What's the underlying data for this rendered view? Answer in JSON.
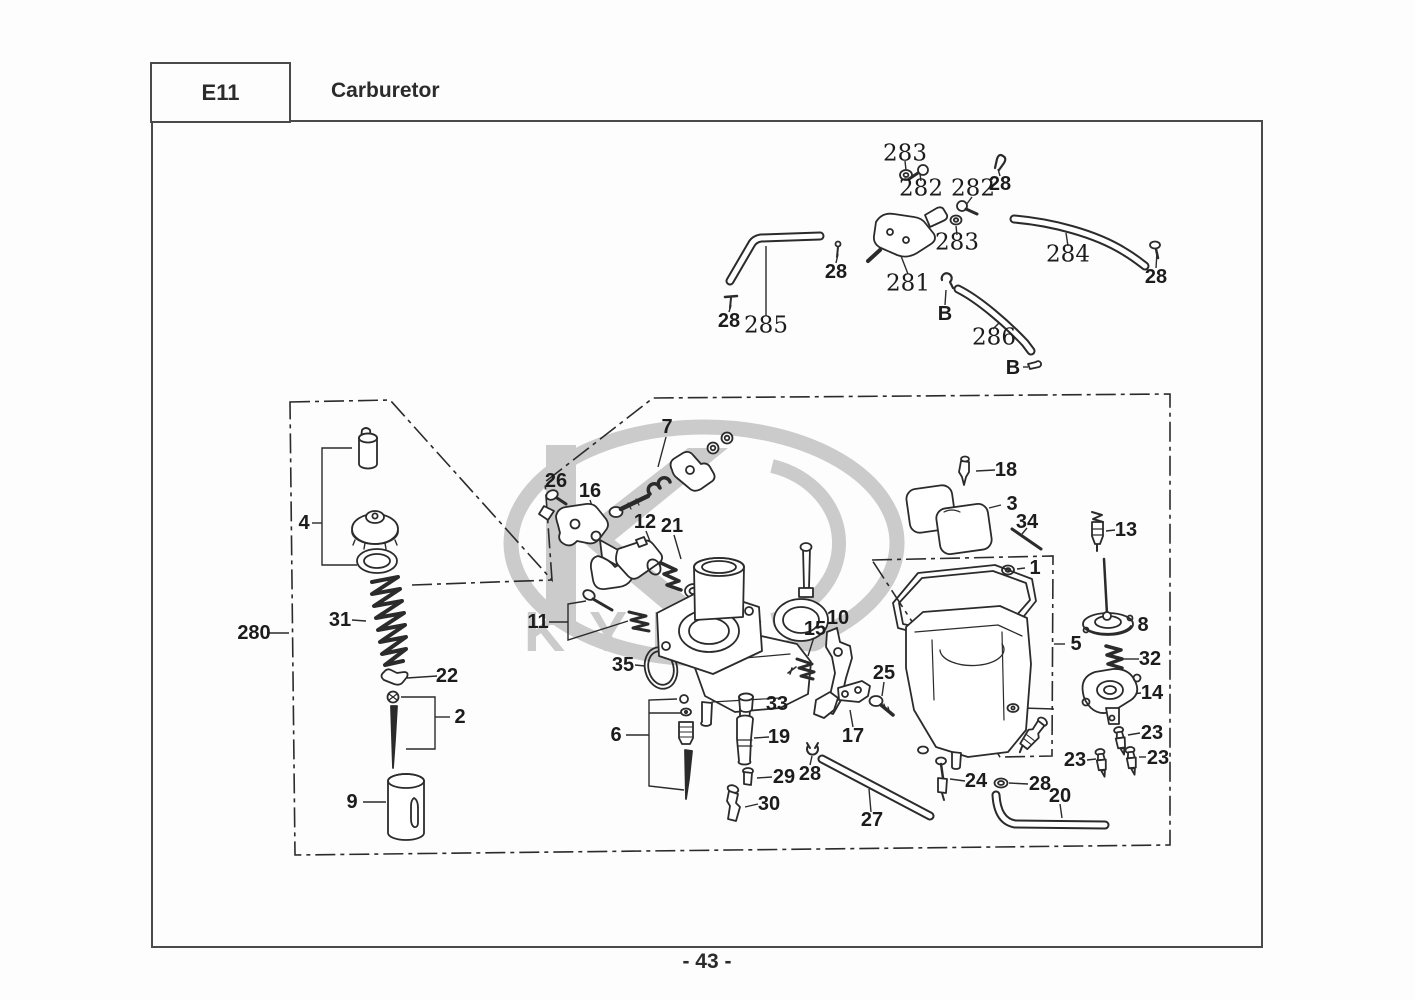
{
  "header": {
    "code": "E11",
    "title": "Carburetor"
  },
  "footer": {
    "page_number": "- 43 -"
  },
  "watermark": {
    "brand": "KYMCO",
    "color": "#cbcbcb"
  },
  "colors": {
    "line": "#2b2b2b",
    "frame": "#4a4a4a",
    "watermark": "#cbcbcb"
  },
  "callouts": [
    {
      "text": "283",
      "x": 905,
      "y": 154,
      "style": "serif"
    },
    {
      "text": "282",
      "x": 921,
      "y": 189,
      "style": "serif"
    },
    {
      "text": "282",
      "x": 973,
      "y": 189,
      "style": "serif"
    },
    {
      "text": "283",
      "x": 957,
      "y": 243,
      "style": "serif"
    },
    {
      "text": "28",
      "x": 1000,
      "y": 184,
      "style": "sans"
    },
    {
      "text": "281",
      "x": 908,
      "y": 284,
      "style": "serif"
    },
    {
      "text": "284",
      "x": 1068,
      "y": 255,
      "style": "serif"
    },
    {
      "text": "28",
      "x": 1156,
      "y": 277,
      "style": "sans"
    },
    {
      "text": "28",
      "x": 836,
      "y": 272,
      "style": "sans"
    },
    {
      "text": "285",
      "x": 766,
      "y": 326,
      "style": "serif"
    },
    {
      "text": "28",
      "x": 729,
      "y": 321,
      "style": "sans"
    },
    {
      "text": "B",
      "x": 945,
      "y": 314,
      "style": "sans"
    },
    {
      "text": "286",
      "x": 994,
      "y": 338,
      "style": "serif"
    },
    {
      "text": "B",
      "x": 1013,
      "y": 368,
      "style": "sans"
    },
    {
      "text": "280",
      "x": 254,
      "y": 633,
      "style": "sans"
    },
    {
      "text": "4",
      "x": 304,
      "y": 523,
      "style": "sans"
    },
    {
      "text": "31",
      "x": 340,
      "y": 620,
      "style": "sans"
    },
    {
      "text": "22",
      "x": 447,
      "y": 676,
      "style": "sans"
    },
    {
      "text": "2",
      "x": 460,
      "y": 717,
      "style": "sans"
    },
    {
      "text": "9",
      "x": 352,
      "y": 802,
      "style": "sans"
    },
    {
      "text": "26",
      "x": 556,
      "y": 481,
      "style": "sans"
    },
    {
      "text": "16",
      "x": 590,
      "y": 491,
      "style": "sans"
    },
    {
      "text": "7",
      "x": 667,
      "y": 427,
      "style": "sans"
    },
    {
      "text": "12",
      "x": 645,
      "y": 522,
      "style": "sans"
    },
    {
      "text": "21",
      "x": 672,
      "y": 526,
      "style": "sans"
    },
    {
      "text": "11",
      "x": 538,
      "y": 622,
      "style": "sans"
    },
    {
      "text": "35",
      "x": 623,
      "y": 665,
      "style": "sans"
    },
    {
      "text": "33",
      "x": 777,
      "y": 704,
      "style": "sans"
    },
    {
      "text": "6",
      "x": 616,
      "y": 735,
      "style": "sans"
    },
    {
      "text": "19",
      "x": 779,
      "y": 737,
      "style": "sans"
    },
    {
      "text": "29",
      "x": 784,
      "y": 777,
      "style": "sans"
    },
    {
      "text": "28",
      "x": 810,
      "y": 774,
      "style": "sans"
    },
    {
      "text": "30",
      "x": 769,
      "y": 804,
      "style": "sans"
    },
    {
      "text": "15",
      "x": 815,
      "y": 629,
      "style": "sans"
    },
    {
      "text": "10",
      "x": 838,
      "y": 618,
      "style": "sans"
    },
    {
      "text": "25",
      "x": 884,
      "y": 673,
      "style": "sans"
    },
    {
      "text": "17",
      "x": 853,
      "y": 736,
      "style": "sans"
    },
    {
      "text": "27",
      "x": 872,
      "y": 820,
      "style": "sans"
    },
    {
      "text": "24",
      "x": 976,
      "y": 781,
      "style": "sans"
    },
    {
      "text": "28",
      "x": 1040,
      "y": 784,
      "style": "sans"
    },
    {
      "text": "20",
      "x": 1060,
      "y": 796,
      "style": "sans"
    },
    {
      "text": "1",
      "x": 1035,
      "y": 568,
      "style": "sans"
    },
    {
      "text": "5",
      "x": 1076,
      "y": 644,
      "style": "sans"
    },
    {
      "text": "18",
      "x": 1006,
      "y": 470,
      "style": "sans"
    },
    {
      "text": "3",
      "x": 1012,
      "y": 504,
      "style": "sans"
    },
    {
      "text": "34",
      "x": 1027,
      "y": 522,
      "style": "sans"
    },
    {
      "text": "13",
      "x": 1126,
      "y": 530,
      "style": "sans"
    },
    {
      "text": "8",
      "x": 1143,
      "y": 625,
      "style": "sans"
    },
    {
      "text": "32",
      "x": 1150,
      "y": 659,
      "style": "sans"
    },
    {
      "text": "14",
      "x": 1152,
      "y": 693,
      "style": "sans"
    },
    {
      "text": "23",
      "x": 1152,
      "y": 733,
      "style": "sans"
    },
    {
      "text": "23",
      "x": 1075,
      "y": 760,
      "style": "sans"
    },
    {
      "text": "23",
      "x": 1158,
      "y": 758,
      "style": "sans"
    }
  ]
}
